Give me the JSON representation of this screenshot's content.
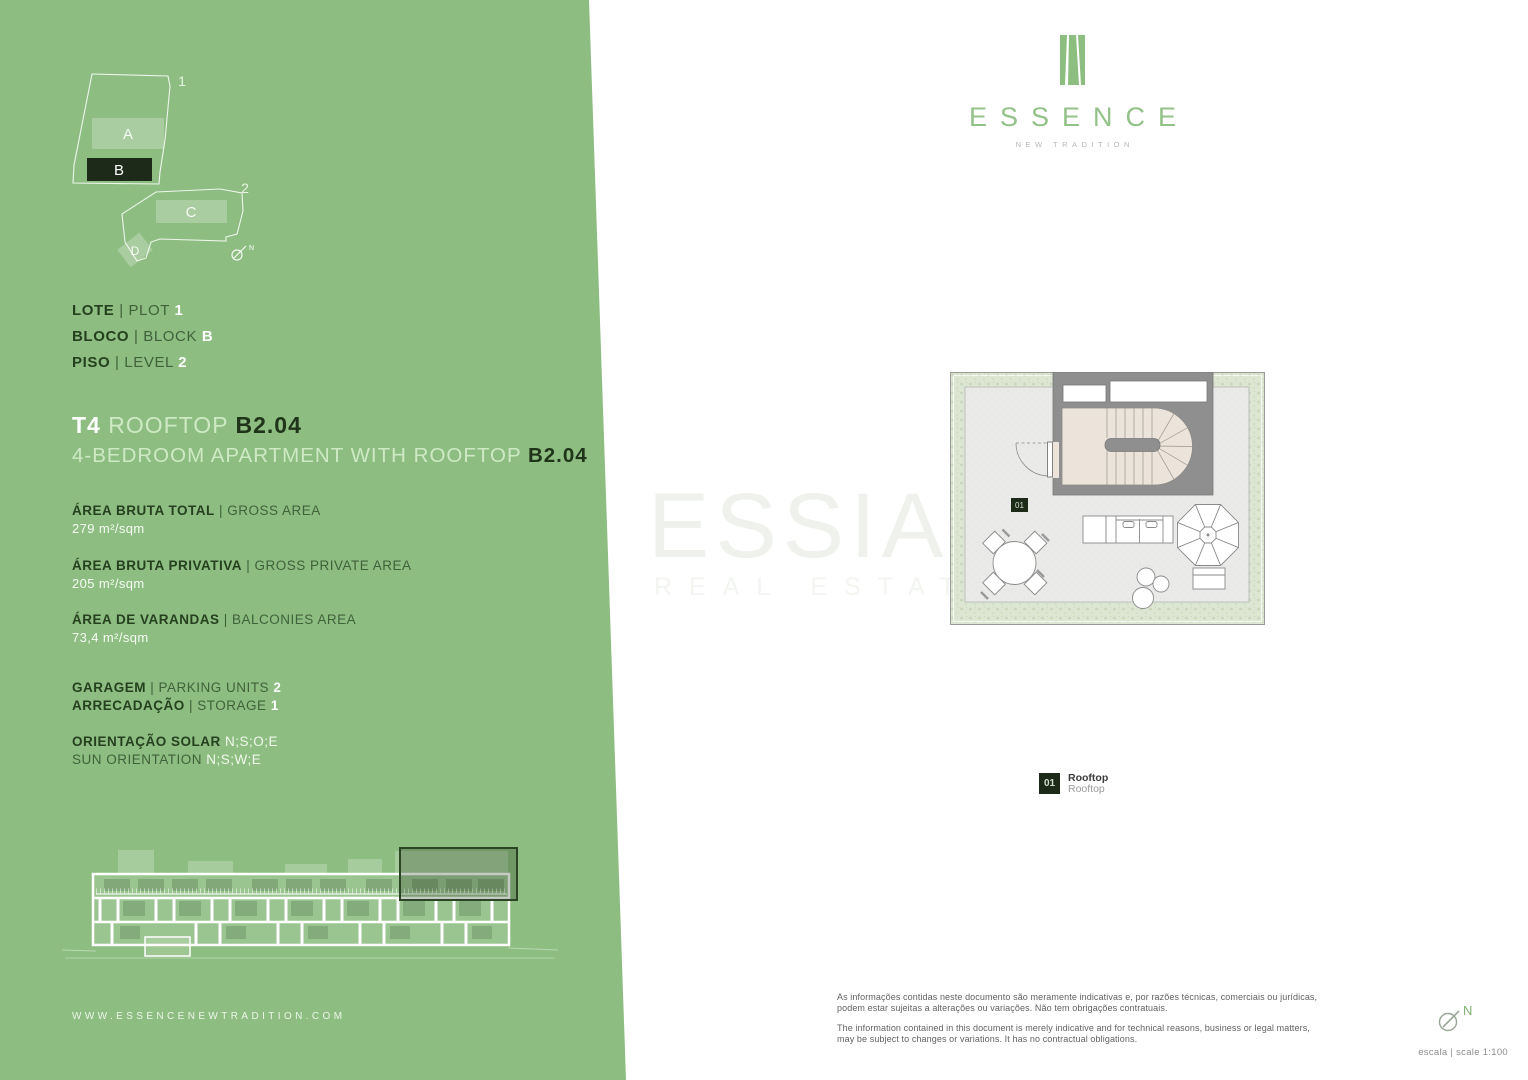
{
  "brand": {
    "logo_text": "ESSENCE",
    "tagline": "NEW TRADITION",
    "website": "WWW.ESSENCENEWTRADITION.COM",
    "watermark_title": "ESSIA",
    "watermark_subtitle": "REAL ESTATE"
  },
  "site_plan": {
    "plot1_number": "1",
    "plot2_number": "2",
    "block_a": "A",
    "block_b": "B",
    "block_c": "C",
    "block_d": "D",
    "north": "N"
  },
  "unit_info": {
    "rows": [
      {
        "pt": "LOTE",
        "en": "| PLOT",
        "value": "1"
      },
      {
        "pt": "BLOCO",
        "en": "| BLOCK",
        "value": "B"
      },
      {
        "pt": "PISO",
        "en": "| LEVEL",
        "value": "2"
      }
    ]
  },
  "title": {
    "type": "T4",
    "name": "ROOFTOP",
    "code": "B2.04",
    "subtitle": "4-BEDROOM APARTMENT WITH ROOFTOP",
    "subtitle_code": "B2.04"
  },
  "areas": {
    "rows": [
      {
        "pt": "ÁREA BRUTA TOTAL",
        "en": "|  GROSS AREA",
        "value": "279 m²/sqm"
      },
      {
        "pt": "ÁREA BRUTA PRIVATIVA",
        "en": "|  GROSS PRIVATE AREA",
        "value": "205 m²/sqm"
      },
      {
        "pt": "ÁREA DE VARANDAS",
        "en": "|  BALCONIES AREA",
        "value": "73,4 m²/sqm"
      }
    ]
  },
  "facilities": {
    "rows": [
      {
        "pt": "GARAGEM",
        "en": "| PARKING UNITS",
        "value": "2"
      },
      {
        "pt": "ARRECADAÇÃO",
        "en": "| STORAGE",
        "value": "1"
      }
    ]
  },
  "orientation": {
    "rows": [
      {
        "label": "ORIENTAÇÃO SOLAR",
        "value": "N;S;O;E"
      },
      {
        "label": "SUN ORIENTATION",
        "value": "N;S;W;E"
      }
    ]
  },
  "floor_plan": {
    "room_badge": "01",
    "north": "N",
    "legend": {
      "number": "01",
      "name": "Rooftop",
      "name_en": "Rooftop"
    }
  },
  "footer": {
    "disclaimer_pt": "As informações contidas neste documento são meramente indicativas e, por razões técnicas, comerciais ou jurídicas, podem estar sujeitas a alterações ou variações. Não tem obrigações contratuais.",
    "disclaimer_en": "The information contained in this document is merely indicative and for technical reasons, business or legal matters, may be subject to changes or variations. It has no contractual obligations.",
    "scale": "escala | scale 1:100"
  },
  "colors": {
    "panel_green": "#8dbd81",
    "dark_green_text": "#26401f",
    "pale_green_text": "#cfe9c4",
    "logo_green": "#93c288",
    "badge_dark": "#1d2a18"
  }
}
